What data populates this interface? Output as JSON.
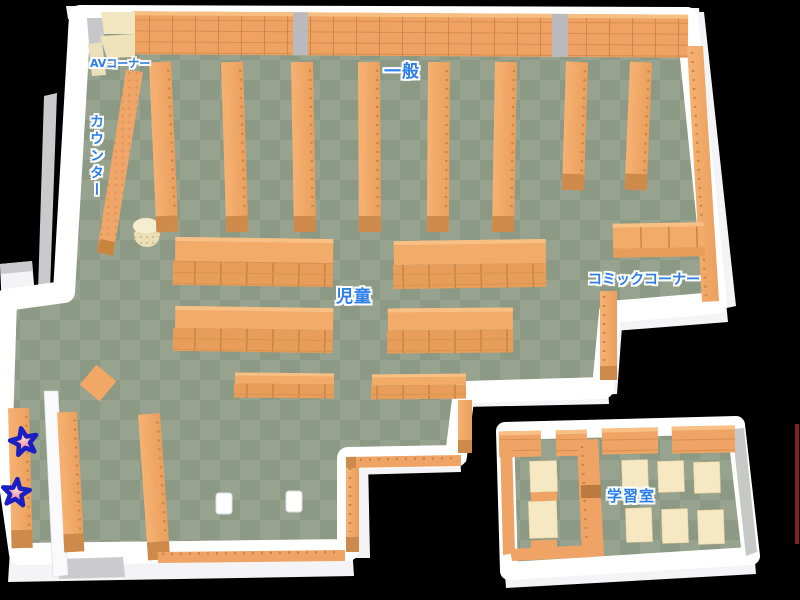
{
  "labels": {
    "av_corner": "AVコーナー",
    "general": "一般",
    "counter": "カウンター",
    "children": "児童",
    "comic_corner": "コミックコーナー",
    "study_room": "学習室"
  },
  "markers": {
    "star_count": 2
  },
  "colors": {
    "background": "#000000",
    "wall": "#FFFFFF",
    "wall_shadow": "#C9C9CE",
    "floor_light": "#97A38E",
    "floor_dark": "#8C9984",
    "shelf_top": "#F3AB69",
    "shelf_front": "#E0924F",
    "shelf_dark": "#CE8A4A",
    "av_shelf": "#F2E6C0",
    "table": "#F6E8C2",
    "label_text": "#2B7DE8",
    "star_fill": "#EE5566",
    "star_outline": "#1A1FC4"
  }
}
